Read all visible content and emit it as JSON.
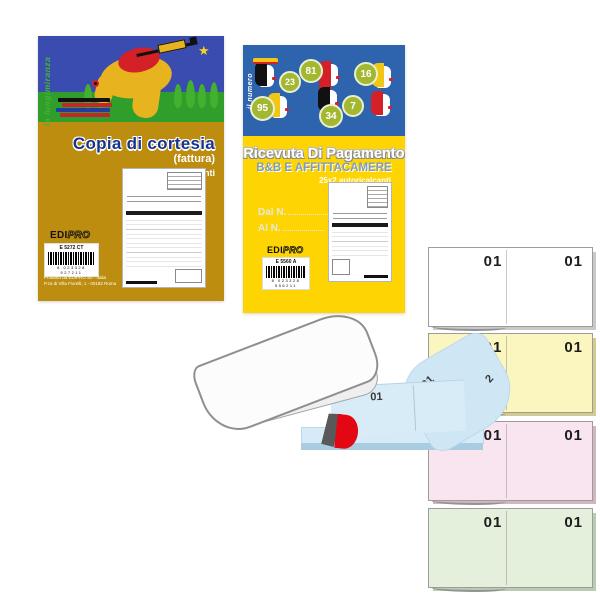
{
  "booklet1": {
    "vertical_label": "la lungimiranza",
    "title": "Copia di cortesia",
    "subtitle": "(fattura)",
    "spec": "33x3 autoricalcanti",
    "brand": {
      "part1": "EDI",
      "part2": "PRO"
    },
    "product_code": "E 5272 CT",
    "barcode_digits": "8 023328 527211",
    "footer_line1": "Prodotto da EDIPRO Srl - Italia",
    "footer_line2": "P.za di Villa Fiorelli, 1 - 00182 Roma",
    "colors": {
      "sky": "#3a4cb0",
      "ground": "#2f9e2b",
      "band": "#bd8d10",
      "title": "#16338e"
    }
  },
  "booklet2": {
    "vertical_label": "il numero",
    "title": "Ricevuta Di Pagamento",
    "subtitle": "B&B E AFFITTACAMERE",
    "spec": "25x2 autoricalcanti",
    "field_from": "Dal N.",
    "field_to": "Al  N.",
    "brand": {
      "part1": "EDI",
      "part2": "PRO"
    },
    "product_code": "E 5560 A",
    "barcode_digits": "8 023328 556211",
    "bubbles": [
      "23",
      "81",
      "16",
      "95",
      "34",
      "7"
    ],
    "colors": {
      "sky": "#2e64ad",
      "band": "#fed503",
      "bubble": "#a3b731",
      "subtitle": "#7f9cba"
    }
  },
  "open_pad": {
    "sheet_numbers": [
      "01",
      "01",
      "2"
    ],
    "colors": {
      "page": "#d8ecf8",
      "base": "#a9cde0",
      "marker": "#e30613"
    }
  },
  "pads": [
    {
      "name": "white",
      "color": "#ffffff",
      "left_number": "01",
      "right_number": "01"
    },
    {
      "name": "yellow",
      "color": "#fbf6bf",
      "left_number": "01",
      "right_number": "01"
    },
    {
      "name": "pink",
      "color": "#f9e5ef",
      "left_number": "01",
      "right_number": "01"
    },
    {
      "name": "green",
      "color": "#e4f0dc",
      "left_number": "01",
      "right_number": "01"
    }
  ]
}
